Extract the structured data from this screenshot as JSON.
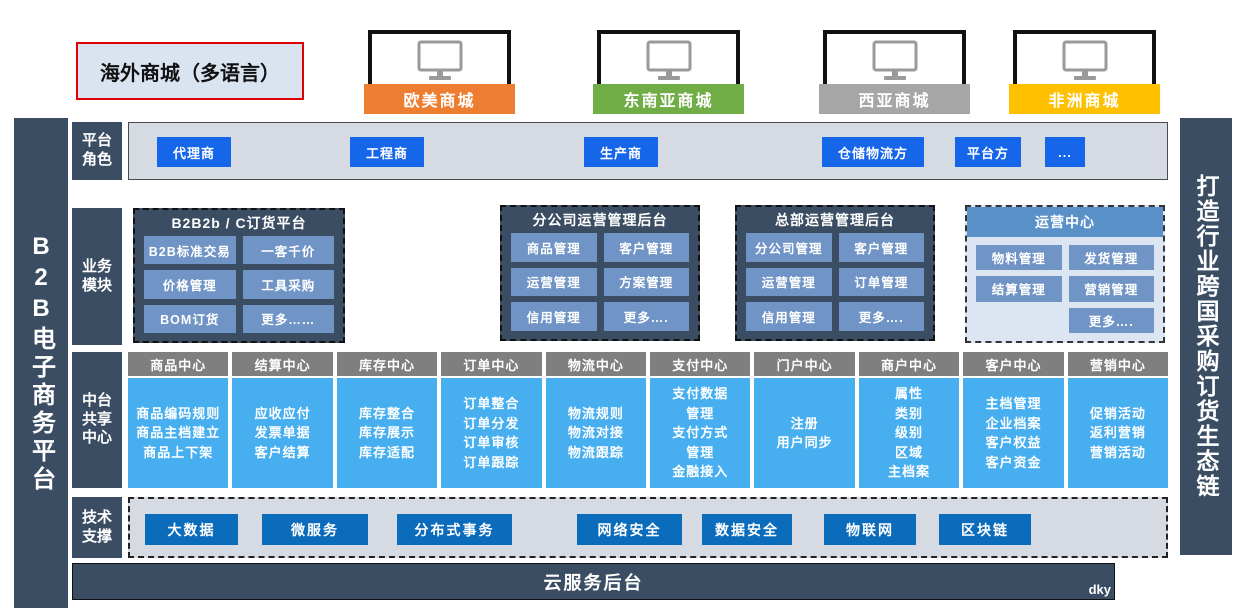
{
  "left_bar": {
    "text": "B2B电子商务平台"
  },
  "right_bar": {
    "text": "打造行业跨国采购订货生态链"
  },
  "overseas_box": {
    "label": "海外商城（多语言）",
    "border_color": "#e00000"
  },
  "malls": [
    {
      "name": "欧美商城",
      "color": "#ed7d31"
    },
    {
      "name": "东南亚商城",
      "color": "#70ad47"
    },
    {
      "name": "西亚商城",
      "color": "#a6a6a6"
    },
    {
      "name": "非洲商城",
      "color": "#ffc000"
    }
  ],
  "roles_row": {
    "label": "平台\n角色",
    "items": [
      {
        "label": "代理商"
      },
      {
        "label": "工程商"
      },
      {
        "label": "生产商"
      },
      {
        "label": "仓储物流方"
      },
      {
        "label": "平台方"
      },
      {
        "label": "..."
      }
    ]
  },
  "modules_row": {
    "label": "业务\n模块",
    "boxes": [
      {
        "title": "B2B2b / C订货平台",
        "items": [
          "B2B标准交易",
          "一客千价",
          "价格管理",
          "工具采购",
          "BOM订货",
          "更多……"
        ]
      },
      {
        "title": "分公司运营管理后台",
        "items": [
          "商品管理",
          "客户管理",
          "运营管理",
          "方案管理",
          "信用管理",
          "更多…."
        ]
      },
      {
        "title": "总部运营管理后台",
        "items": [
          "分公司管理",
          "客户管理",
          "运营管理",
          "订单管理",
          "信用管理",
          "更多…."
        ]
      },
      {
        "title": "运营中心",
        "items": [
          "物料管理",
          "发货管理",
          "结算管理",
          "营销管理",
          "更多…."
        ]
      }
    ]
  },
  "mid_row": {
    "label": "中台\n共享\n中心",
    "columns": [
      {
        "title": "商品中心",
        "items": [
          "商品编码规则",
          "商品主档建立",
          "商品上下架"
        ]
      },
      {
        "title": "结算中心",
        "items": [
          "应收应付",
          "发票单据",
          "客户结算"
        ]
      },
      {
        "title": "库存中心",
        "items": [
          "库存整合",
          "库存展示",
          "库存适配"
        ]
      },
      {
        "title": "订单中心",
        "items": [
          "订单整合",
          "订单分发",
          "订单审核",
          "订单跟踪"
        ]
      },
      {
        "title": "物流中心",
        "items": [
          "物流规则",
          "物流对接",
          "物流跟踪"
        ]
      },
      {
        "title": "支付中心",
        "items": [
          "支付数据\n管理",
          "支付方式\n管理",
          "金融接入"
        ]
      },
      {
        "title": "门户中心",
        "items": [
          "注册",
          "用户同步"
        ]
      },
      {
        "title": "商户中心",
        "items": [
          "属性",
          "类别",
          "级别",
          "区域",
          "主档案"
        ]
      },
      {
        "title": "客户中心",
        "items": [
          "主档管理",
          "企业档案",
          "客户权益",
          "客户资金"
        ]
      },
      {
        "title": "营销中心",
        "items": [
          "促销活动",
          "返利营销",
          "营销活动"
        ]
      }
    ]
  },
  "tech_row": {
    "label": "技术\n支撑",
    "items": [
      {
        "label": "大数据"
      },
      {
        "label": "微服务"
      },
      {
        "label": "分布式事务"
      },
      {
        "label": "网络安全"
      },
      {
        "label": "数据安全"
      },
      {
        "label": "物联网"
      },
      {
        "label": "区块链"
      }
    ]
  },
  "cloud_bar": {
    "label": "云服务后台",
    "watermark": "dky"
  },
  "colors": {
    "dark_slate": "#3b4d63",
    "role_button_blue": "#1666ea",
    "module_button_blue": "#7094c5",
    "ops_header_blue": "#5b91c9",
    "mid_header_gray": "#7f7f7f",
    "mid_body_blue": "#47aff0",
    "tech_button_blue": "#0c6cbc",
    "panel_gray": "#d6dbe3"
  }
}
